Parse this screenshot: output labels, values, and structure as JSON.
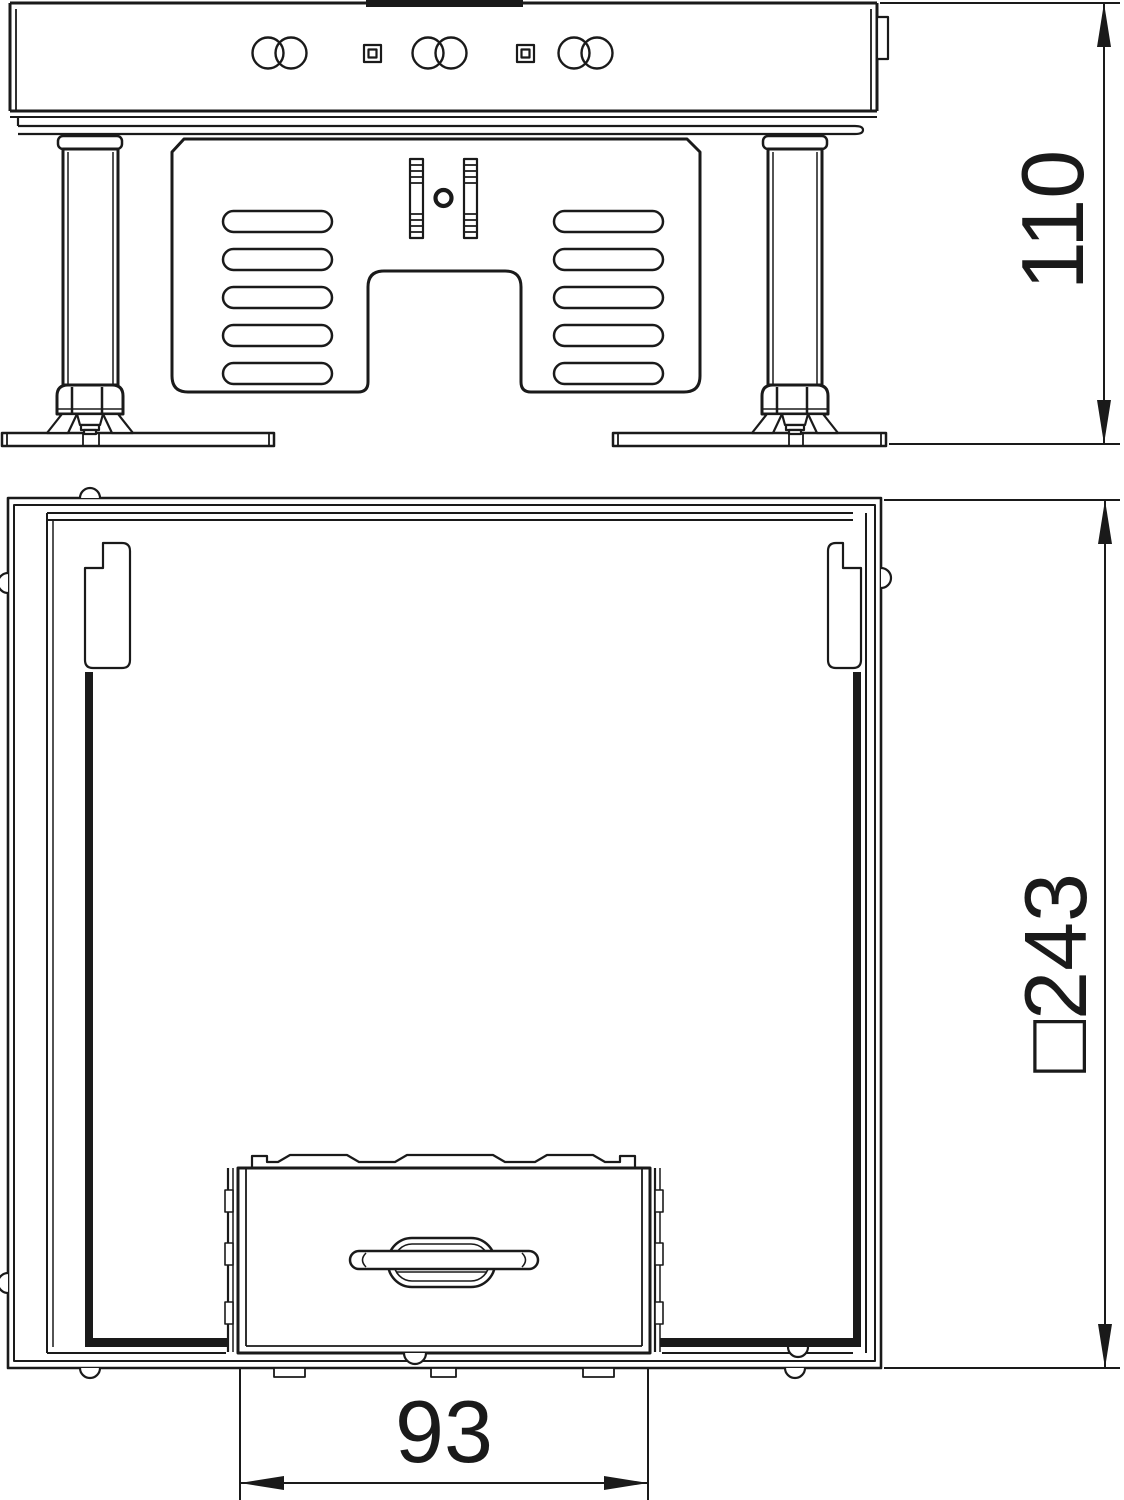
{
  "colors": {
    "background": "#ffffff",
    "ink": "#1a1a1a"
  },
  "views": {
    "side_elevation": {
      "name": "side-elevation-with-leveling-feet"
    },
    "plan": {
      "name": "plan-view-square-frame-with-cassette"
    }
  },
  "dimensions": {
    "height": {
      "label": "110",
      "orientation": "vertical-rotated"
    },
    "square": {
      "label": "□243",
      "orientation": "vertical-rotated",
      "prefix": "□",
      "value": "243"
    },
    "cassette_width": {
      "label": "93",
      "orientation": "horizontal"
    }
  }
}
